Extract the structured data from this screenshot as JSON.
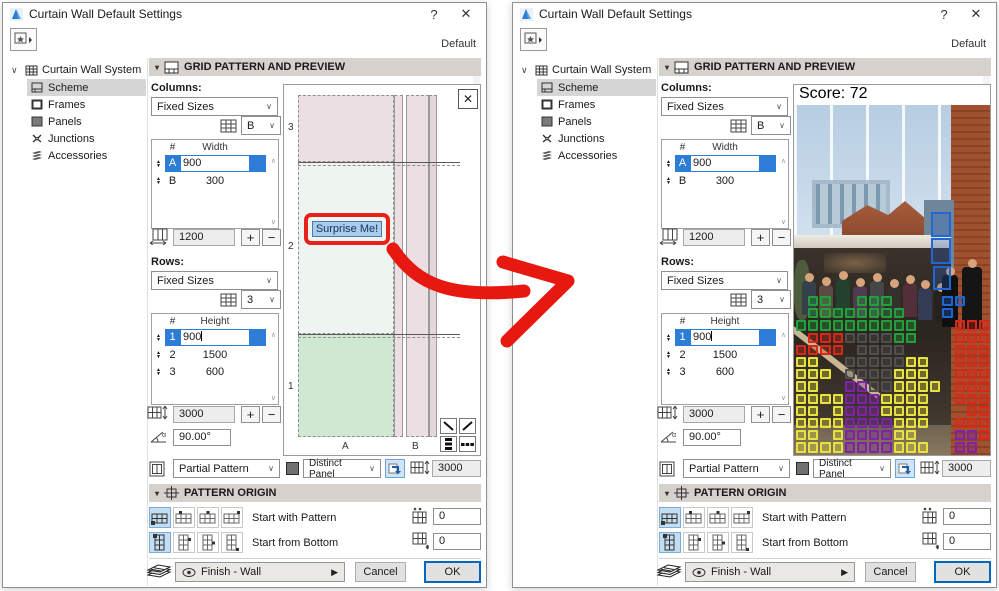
{
  "window": {
    "title": "Curtain Wall Default Settings",
    "help_label": "?",
    "close_label": "✕",
    "default_label": "Default"
  },
  "sidebar": {
    "root_label": "Curtain Wall System",
    "items": [
      {
        "label": "Scheme"
      },
      {
        "label": "Frames"
      },
      {
        "label": "Panels"
      },
      {
        "label": "Junctions"
      },
      {
        "label": "Accessories"
      }
    ],
    "selected": "Scheme"
  },
  "sections": {
    "grid_pattern": "GRID PATTERN AND PREVIEW",
    "pattern_origin": "PATTERN ORIGIN"
  },
  "columns": {
    "label": "Columns:",
    "scheme": "Fixed Sizes",
    "ref_value": "B",
    "headers": {
      "num": "#",
      "size": "Width"
    },
    "rows": [
      {
        "id": "A",
        "value": "900"
      },
      {
        "id": "B",
        "value": "300"
      }
    ],
    "total": "1200",
    "plus": "+",
    "minus": "−"
  },
  "rows": {
    "label": "Rows:",
    "scheme": "Fixed Sizes",
    "ref_value": "3",
    "headers": {
      "num": "#",
      "size": "Height"
    },
    "rows": [
      {
        "id": "1",
        "value": "900"
      },
      {
        "id": "2",
        "value": "1500"
      },
      {
        "id": "3",
        "value": "600"
      }
    ],
    "total": "3000",
    "plus": "+",
    "minus": "−",
    "angle": "90.00°"
  },
  "pattern_row": {
    "pattern_option": "Partial Pattern",
    "panel_option": "Distinct Panel",
    "pattern_height": "3000"
  },
  "pattern_origin": {
    "with_pattern_label": "Start with Pattern",
    "from_bottom_label": "Start from Bottom",
    "offset_x": "0",
    "offset_y": "0"
  },
  "footer": {
    "finish_label": "Finish - Wall",
    "cancel_label": "Cancel",
    "ok_label": "OK"
  },
  "preview": {
    "row_axis_labels": [
      "3",
      "2",
      "1"
    ],
    "col_axis_labels": [
      "A",
      "B"
    ],
    "surprise_button": "Surprise Me!"
  },
  "photo": {
    "score_label": "Score: 72",
    "grid_overlay": {
      "cell_px": 12.2,
      "origin": {
        "x": 2,
        "y": 211
      },
      "colors": {
        "G": "#21a03c",
        "R": "#d92818",
        "K": "#4f4f4f",
        "Y": "#e8e23c",
        "P": "#7e22a8",
        "B": "#1f66d6"
      },
      "cells": [
        ".GG..GGG....BB..",
        ".GGGGGGGG...B...",
        "GGGGGGGGGG...RRR",
        ".RRRKKKKGG...RRR",
        "RRRR.KKKK....RRR",
        "YY..KKKKKYY..RRR",
        "YYY.KKKKYYY..RRR",
        "YY..PPKKYYYY.RRR",
        "YYYYPPPYYYY..RRR",
        "YY.YPPPYYYY...RR",
        "YYYYPPPPYYY..RRR",
        "YY.YPPPPYY...PPR",
        "YYYYPPPPYYY..PP."
      ],
      "extra_boxes": [
        {
          "x": 137,
          "y": 127,
          "w": 20,
          "h": 25,
          "color": "B"
        },
        {
          "x": 137,
          "y": 153,
          "w": 20,
          "h": 26,
          "color": "B"
        },
        {
          "x": 139,
          "y": 181,
          "w": 18,
          "h": 24,
          "color": "B"
        }
      ]
    }
  }
}
